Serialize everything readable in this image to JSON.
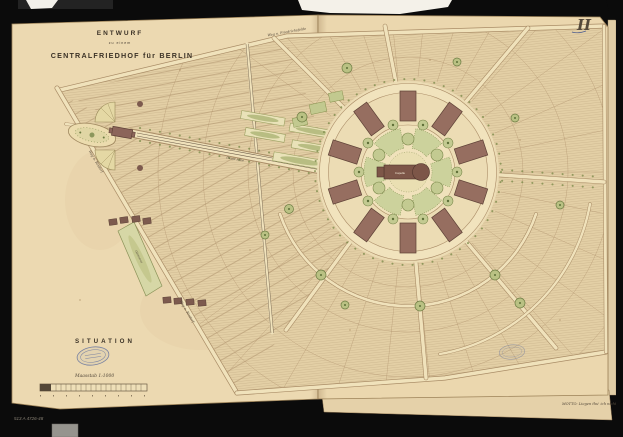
{
  "plate": {
    "sheet_number": "II",
    "title_line1": "ENTWURF",
    "title_line2": "zu einem",
    "title_line3": "CENTRALFRIEDHOF für BERLIN",
    "situation_label": "SITUATION",
    "scale_note": "Maasstab 1:1000",
    "motto": "MOTTO: Liegen thu' ich nicht",
    "catalog_number": "513 A 4726-48"
  },
  "map_labels": {
    "road_top": "Weg n. Friedrichsfelde",
    "road_left_upper": "Weg n. Rixdorf",
    "road_left_lower": "Weg n. Rixdorf",
    "main_avenue": "Haupt Allee",
    "nursery_strip": "Gärtnerei",
    "central_building": "Capelle"
  },
  "colors": {
    "background": "#0b0b0b",
    "paper": "#ecd9b1",
    "field_hatch": "#cdb78e",
    "building": "#966e60",
    "garden_green": "#c3ca91",
    "stamp_blue": "#5c6c9e",
    "ink": "#3b3226"
  }
}
